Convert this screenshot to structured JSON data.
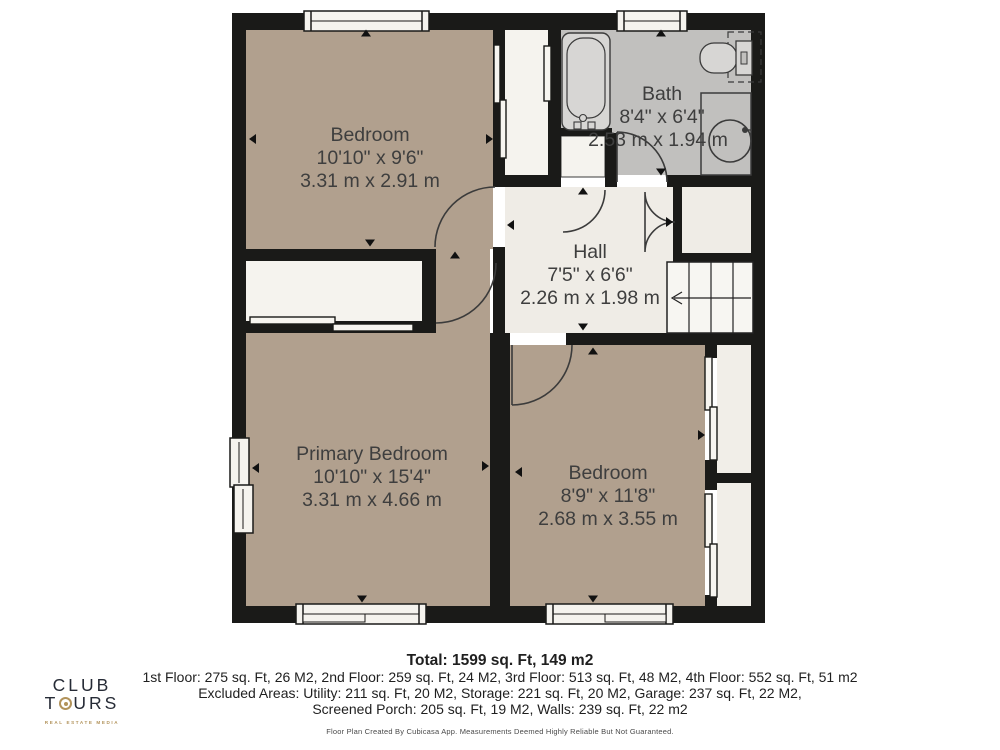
{
  "plan": {
    "rooms": [
      {
        "id": "bedroom-top",
        "name": "Bedroom",
        "imperial": "10'10\" x 9'6\"",
        "metric": "3.31 m x 2.91 m"
      },
      {
        "id": "bath",
        "name": "Bath",
        "imperial": "8'4\" x 6'4\"",
        "metric": "2.53 m x 1.94 m"
      },
      {
        "id": "hall",
        "name": "Hall",
        "imperial": "7'5\" x 6'6\"",
        "metric": "2.26 m x 1.98 m"
      },
      {
        "id": "primary-bedroom",
        "name": "Primary Bedroom",
        "imperial": "10'10\" x 15'4\"",
        "metric": "3.31 m x 4.66 m"
      },
      {
        "id": "bedroom-bottom",
        "name": "Bedroom",
        "imperial": "8'9\" x 11'8\"",
        "metric": "2.68 m x 3.55 m"
      }
    ],
    "fixtures": [
      "bathtub",
      "toilet",
      "sink",
      "staircase"
    ],
    "colors": {
      "wall": "#1a1a18",
      "floor_tan": "#b1a08e",
      "floor_gray": "#c1c0be",
      "floor_cream": "#efece6",
      "floor_white": "#f5f3ee",
      "fixture_fill": "#d7d6d4",
      "label_text": "#3e3e3e"
    }
  },
  "summary": {
    "total": "Total: 1599 sq. Ft, 149 m2",
    "line2": "1st Floor: 275 sq. Ft, 26 M2, 2nd Floor: 259 sq. Ft, 24 M2, 3rd Floor: 513 sq. Ft, 48 M2, 4th Floor: 552 sq. Ft, 51 m2",
    "line3": "Excluded Areas: Utility: 211 sq. Ft, 20 M2, Storage: 221 sq. Ft, 20 M2, Garage: 237 sq. Ft, 22 M2,",
    "line4": "Screened Porch: 205 sq. Ft, 19 M2, Walls: 239 sq. Ft, 22 m2",
    "disclaimer": "Floor Plan Created By Cubicasa App. Measurements Deemed Highly Reliable But Not Guaranteed."
  },
  "logo": {
    "word1": "CLUB",
    "word2_start": "T",
    "word2_end": "URS",
    "tagline": "REAL ESTATE MEDIA",
    "gold": "#b2935b",
    "ink": "#262b36"
  }
}
